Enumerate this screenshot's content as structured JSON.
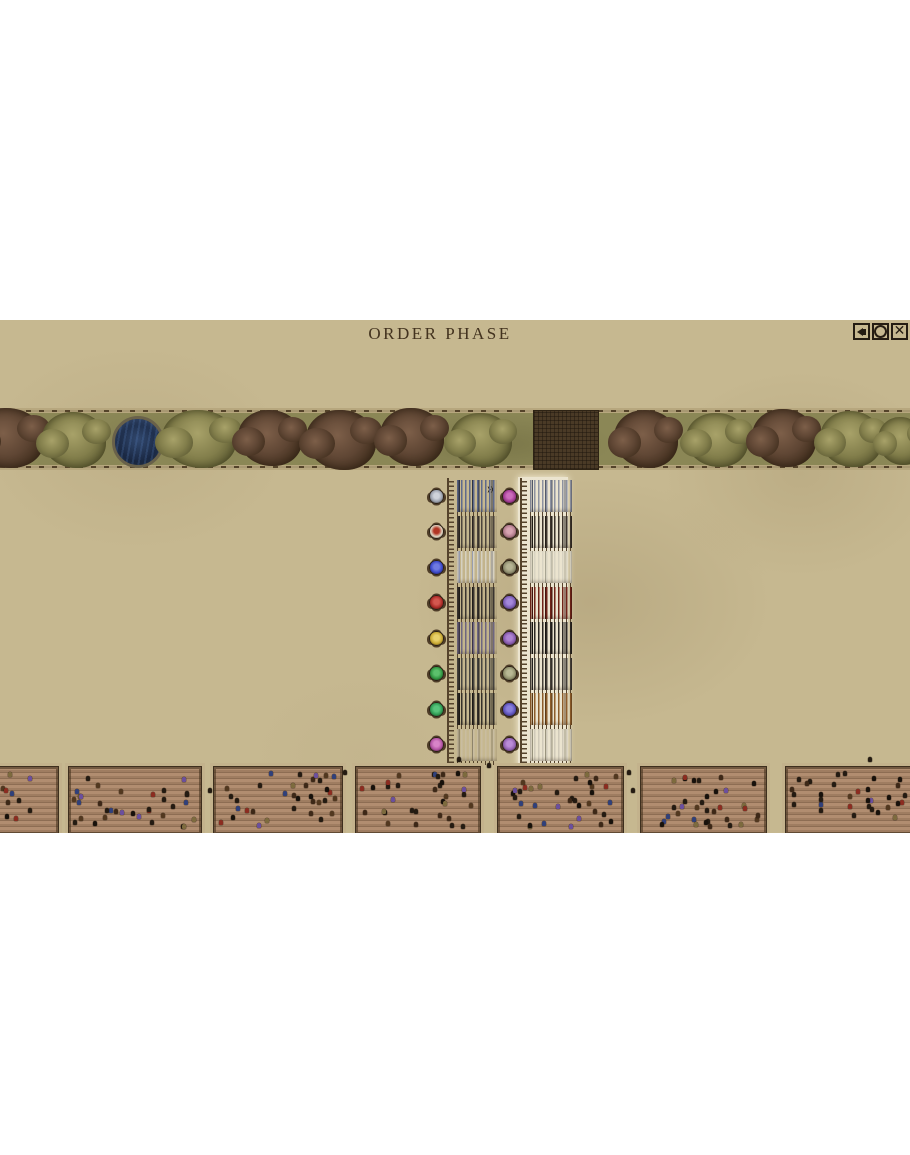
{
  "hud": {
    "phase_label": "ORDER PHASE",
    "marker": "»",
    "close_glyph": "✕",
    "buttons": [
      {
        "name": "mute-button",
        "icon": "speaker-icon"
      },
      {
        "name": "window-button",
        "icon": "circle-icon"
      },
      {
        "name": "close-button",
        "icon": "close-icon"
      }
    ]
  },
  "colors": {
    "background_tan": "#c6b890",
    "strip_green": "#8b8756",
    "fence_brown": "#54432a",
    "highlight_band": "#ebe4cf",
    "pond_water": "#1d2c48",
    "plot_soil": "#4a3a26",
    "field_soil": "#a5816a",
    "title_text": "#43331f"
  },
  "terrain": {
    "items": [
      {
        "type": "tree-brown",
        "x": -30,
        "w": 74,
        "h": 60,
        "dy": -1
      },
      {
        "type": "tree-green",
        "x": 42,
        "w": 64,
        "h": 56,
        "dy": 1
      },
      {
        "type": "pond",
        "x": 112,
        "w": 46,
        "h": 46,
        "dy": 0
      },
      {
        "type": "tree-green",
        "x": 162,
        "w": 74,
        "h": 58,
        "dy": 0
      },
      {
        "type": "tree-brown",
        "x": 238,
        "w": 64,
        "h": 56,
        "dy": -1
      },
      {
        "type": "tree-brown",
        "x": 306,
        "w": 70,
        "h": 60,
        "dy": 1
      },
      {
        "type": "tree-brown",
        "x": 380,
        "w": 64,
        "h": 58,
        "dy": -2
      },
      {
        "type": "tree-green",
        "x": 450,
        "w": 62,
        "h": 54,
        "dy": 1
      },
      {
        "type": "plot",
        "x": 533,
        "w": 64,
        "h": 58,
        "dy": 0
      },
      {
        "type": "tree-brown",
        "x": 614,
        "w": 64,
        "h": 58,
        "dy": 0
      },
      {
        "type": "tree-green",
        "x": 686,
        "w": 62,
        "h": 54,
        "dy": 1
      },
      {
        "type": "tree-brown",
        "x": 752,
        "w": 64,
        "h": 58,
        "dy": -1
      },
      {
        "type": "tree-green",
        "x": 820,
        "w": 62,
        "h": 56,
        "dy": 0
      },
      {
        "type": "tree-green",
        "x": 878,
        "w": 46,
        "h": 48,
        "dy": 2
      }
    ]
  },
  "armies": {
    "row_top": 160,
    "row_step": 35.5,
    "row_h": 32,
    "left": {
      "x": 429,
      "troop_w": 40,
      "units": [
        {
          "leader": "#9aa0ac",
          "leader_inner": "#cfd3da",
          "troop": "#5f6a8c",
          "troop2": "#2e3442"
        },
        {
          "leader": "#e2d9c6",
          "leader_inner": "#b23524",
          "troop": "#4c443c",
          "troop2": "#292420"
        },
        {
          "leader": "#3946c8",
          "leader_inner": "#6f7ae0",
          "troop": "#d6d1c0",
          "troop2": "#989eb0"
        },
        {
          "leader": "#aa2a26",
          "leader_inner": "#d4574f",
          "troop": "#3a3530",
          "troop2": "#201d19"
        },
        {
          "leader": "#c8a832",
          "leader_inner": "#e8d06a",
          "troop": "#6e6680",
          "troop2": "#3b3547"
        },
        {
          "leader": "#2f9440",
          "leader_inner": "#5cc06c",
          "troop": "#474540",
          "troop2": "#262522"
        },
        {
          "leader": "#2e9a52",
          "leader_inner": "#58c47c",
          "troop": "#34302a",
          "troop2": "#1c1915"
        },
        {
          "leader": "#b052a2",
          "leader_inner": "#d884c8",
          "troop": "#c9bda0",
          "troop2": "#8e846b"
        }
      ]
    },
    "right": {
      "x": 502,
      "troop_w": 42,
      "units": [
        {
          "leader": "#a03a92",
          "leader_inner": "#cc6cbc",
          "troop": "#8d92a0",
          "troop2": "#545a6a"
        },
        {
          "leader": "#b07a8a",
          "leader_inner": "#d8a4b2",
          "troop": "#3c342c",
          "troop2": "#221d17"
        },
        {
          "leader": "#8e8c6e",
          "leader_inner": "#b6b494",
          "troop": "#d8d3c2",
          "troop2": "#a8a592"
        },
        {
          "leader": "#7a5cb4",
          "leader_inner": "#a488da",
          "troop": "#6e2318",
          "troop2": "#42140e"
        },
        {
          "leader": "#8458aa",
          "leader_inner": "#ae84d2",
          "troop": "#2c2823",
          "troop2": "#171411"
        },
        {
          "leader": "#90906c",
          "leader_inner": "#b8b894",
          "troop": "#454038",
          "troop2": "#252220"
        },
        {
          "leader": "#5a50b8",
          "leader_inner": "#8a80dc",
          "troop": "#8c5c2a",
          "troop2": "#5c3b18"
        },
        {
          "leader": "#9060b0",
          "leader_inner": "#ba8cd8",
          "troop": "#cfc9b8",
          "troop2": "#9a947e"
        }
      ]
    }
  },
  "camps": {
    "y": 446,
    "h": 67,
    "palette": [
      "#241b12",
      "#17110b",
      "#3d2817",
      "#52381f",
      "#6b4f9e",
      "#30407a",
      "#8c2c20",
      "#7d6b3e"
    ],
    "stray_color": "#241b12",
    "fields": [
      {
        "x": -70,
        "w": 127,
        "seed": 11,
        "figures": 24
      },
      {
        "x": 68,
        "w": 132,
        "seed": 23,
        "figures": 34
      },
      {
        "x": 213,
        "w": 128,
        "seed": 37,
        "figures": 34
      },
      {
        "x": 355,
        "w": 124,
        "seed": 53,
        "figures": 33
      },
      {
        "x": 497,
        "w": 125,
        "seed": 71,
        "figures": 36
      },
      {
        "x": 640,
        "w": 125,
        "seed": 89,
        "figures": 34
      },
      {
        "x": 785,
        "w": 130,
        "seed": 101,
        "figures": 32
      }
    ]
  },
  "strays": [
    {
      "x": 343,
      "y": 450
    },
    {
      "x": 457,
      "y": 437
    },
    {
      "x": 487,
      "y": 443
    },
    {
      "x": 627,
      "y": 450
    },
    {
      "x": 631,
      "y": 468
    },
    {
      "x": 208,
      "y": 468
    },
    {
      "x": 868,
      "y": 437
    }
  ],
  "cursor": {
    "x": 284,
    "y": 502
  }
}
